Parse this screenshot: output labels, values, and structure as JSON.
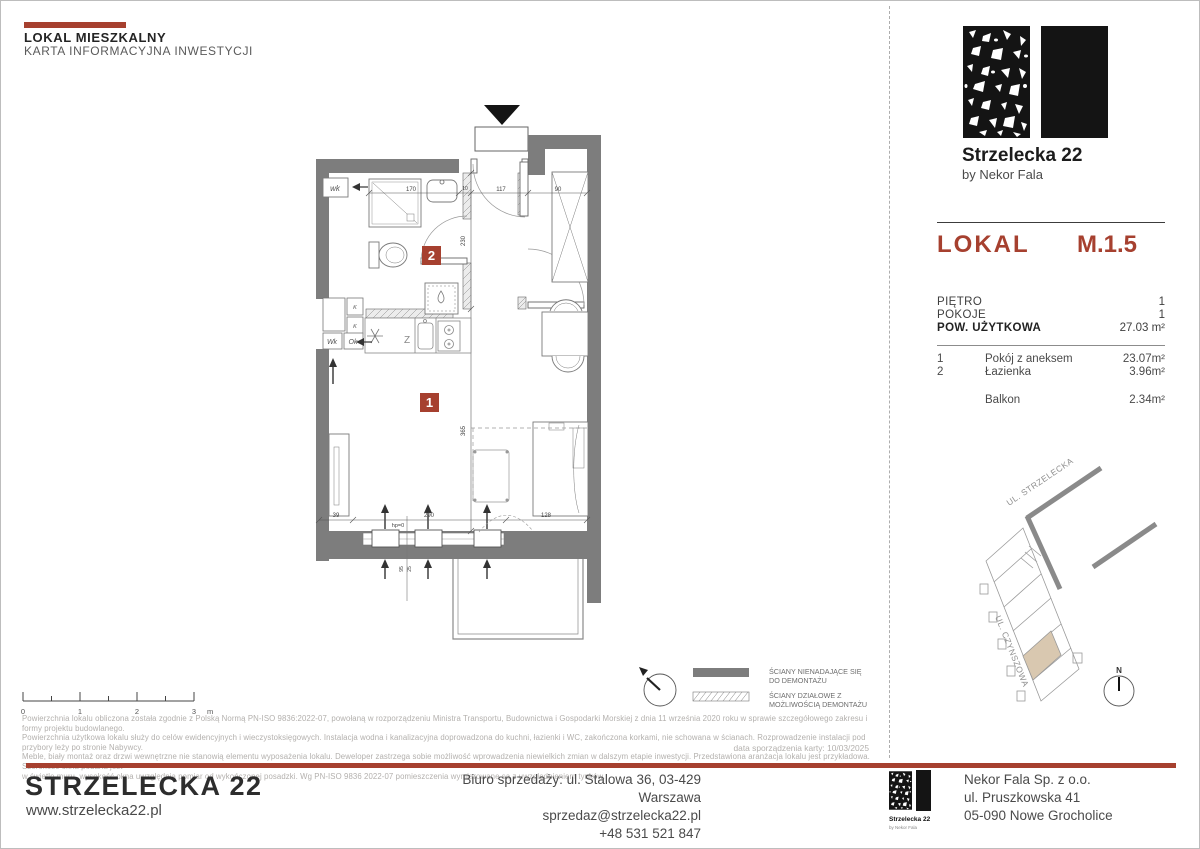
{
  "header": {
    "title": "LOKAL MIESZKALNY",
    "subtitle": "KARTA INFORMACYJNA INWESTYCJI"
  },
  "brand": {
    "name": "Strzelecka 22",
    "byline": "by Nekor Fala"
  },
  "unit": {
    "label": "LOKAL",
    "number": "M.1.5",
    "attrs": [
      {
        "label": "PIĘTRO",
        "value": "1"
      },
      {
        "label": "POKOJE",
        "value": "1"
      },
      {
        "label": "POW. UŻYTKOWA",
        "value": "27.03 m²"
      }
    ],
    "rooms": [
      {
        "no": "1",
        "name": "Pokój z aneksem",
        "area": "23.07m²"
      },
      {
        "no": "2",
        "name": "Łazienka",
        "area": "3.96m²"
      }
    ],
    "balcony": {
      "name": "Balkon",
      "area": "2.34m²"
    }
  },
  "plan": {
    "room_labels": {
      "living": "1",
      "bath": "2"
    },
    "dims": {
      "shower": "170",
      "gap": "10",
      "hall": "117",
      "wardrobe": "90",
      "bath_depth": "230",
      "room_depth": "365",
      "left": "39",
      "window": "290",
      "bed": "128",
      "sill": "hp=0",
      "vent_a": "95",
      "vent_b": "25"
    },
    "tags": {
      "wk_corridor": "wk",
      "shaft_k1": "K",
      "shaft_k2": "K",
      "shaft_wk": "Wk",
      "shaft_ok": "Ok",
      "kitchen_z": "Z"
    }
  },
  "legend": {
    "solid": [
      "ŚCIANY NIENADAJĄCE SIĘ",
      "DO DEMONTAŻU"
    ],
    "hatched": [
      "ŚCIANY DZIAŁOWE Z",
      "MOŻLIWOŚCIĄ DEMONTAŻU"
    ]
  },
  "scalebar": {
    "ticks": [
      "0",
      "1",
      "2",
      "3"
    ],
    "unit": "m"
  },
  "sitemap": {
    "street_top": "UL. STRZELECKA",
    "street_left": "UL. CZYNSZOWA",
    "north": "N"
  },
  "disclaimer": {
    "lines": [
      "Powierzchnia lokalu obliczona została zgodnie z Polską Normą PN-ISO 9836:2022-07, powołaną w rozporządzeniu Ministra Transportu, Budownictwa i Gospodarki Morskiej z dnia 11 września 2020 roku w sprawie szczegółowego zakresu i formy projektu budowlanego.",
      "Powierzchnia użytkowa lokalu służy do celów ewidencyjnych i wieczystoksięgowych. Instalacja wodna i kanalizacyjna doprowadzona do kuchni, łazienki i WC, zakończona korkami, nie schowana w ścianach. Rozprowadzenie instalacji pod przybory leży po stronie Nabywcy.",
      "Meble, biały montaż oraz drzwi wewnętrzne nie stanowią elementu wyposażenia lokalu. Deweloper zastrzega sobie możliwość wprowadzenia niewielkich zmian w dalszym etapie inwestycji. Przedstawiona aranżacja lokalu jest przykładowa. Szerokość okna podana jest",
      "w świetle muru, wysokość okna uwzględnia pomiar od wykończonej posadzki. Wg PN-ISO 9836 2022-07 pomieszczenia wymiarowane są z uwzględnieniem tynków."
    ],
    "date": "data sporządzenia karty: 10/03/2025"
  },
  "footer": {
    "brand": "STRZELECKA 22",
    "website": "www.strzelecka22.pl",
    "office_lines": [
      "Biuro sprzedaży: ul. Stalowa 36, 03-429 Warszawa",
      "sprzedaz@strzelecka22.pl",
      "+48 531 521 847"
    ],
    "logo": {
      "name": "Strzelecka 22",
      "byline": "by Nekor Fala"
    },
    "company_lines": [
      "Nekor Fala Sp. z o.o.",
      "ul. Pruszkowska 41",
      "05-090 Nowe Grocholice"
    ]
  },
  "colors": {
    "accent": "#A6402F",
    "wall": "#7D7D7D",
    "unit_highlight": "#D9C8B0"
  }
}
